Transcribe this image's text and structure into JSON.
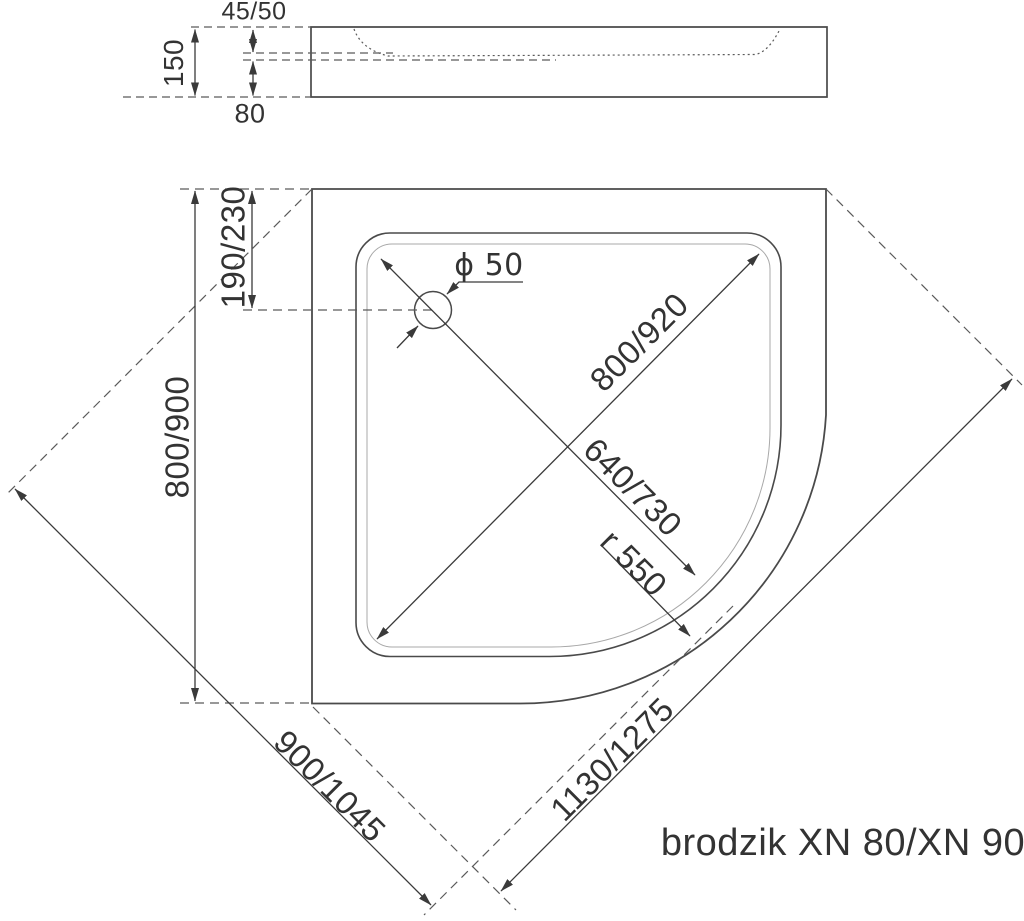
{
  "product_label": "brodzik XN 80/XN 90",
  "side_view": {
    "total_height": "150",
    "rim_depth": "45/50",
    "base_height": "80"
  },
  "top_view": {
    "drain_offset": "190/230",
    "wall_dimension": "800/900",
    "drain_diameter": "ϕ 50",
    "inner_diagonal": "800/920",
    "basin_diagonal": "640/730",
    "front_radius": "r 550",
    "left_diagonal": "900/1045",
    "right_diagonal": "1130/1275"
  },
  "colors": {
    "line": "#4a4a4a",
    "dim": "#3a3a3a",
    "dash": "#5a5a5a",
    "thin": "#a8a8a8",
    "text": "#333333",
    "bg": "#ffffff"
  }
}
